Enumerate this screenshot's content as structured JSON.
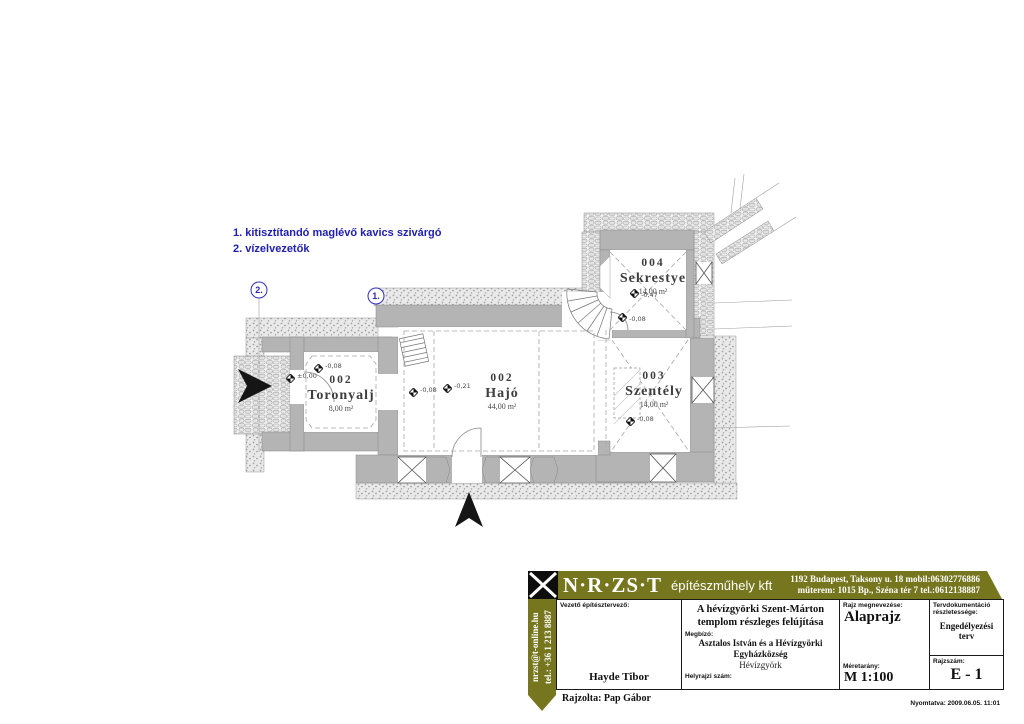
{
  "notes": {
    "line1": "1. kitisztítandó maglévő kavics szivárgó",
    "line2": "2. vízelvezetők",
    "color": "#2020b2"
  },
  "plan": {
    "rooms": [
      {
        "number": "002",
        "name": "Toronyalj",
        "area": "8,00 m²"
      },
      {
        "number": "002",
        "name": "Hajó",
        "area": "44,00 m²"
      },
      {
        "number": "003",
        "name": "Szentély",
        "area": "14,00 m²"
      },
      {
        "number": "004",
        "name": "Sekrestye",
        "area": "14,00 m²"
      }
    ],
    "levels": {
      "entry": "±0,00",
      "tower_ne": "-0,08",
      "hajo_w": "-0,08",
      "hajo": "-0,21",
      "szentely": "-0,08",
      "sekrestye_upper": "-0,47",
      "sekrestye_lower": "-0,08"
    },
    "callout_1": "1.",
    "callout_2": "2."
  },
  "titleblock": {
    "brand": "N·R·ZS·T",
    "brand_sub": "építészműhely kft",
    "brand_color": "#76761f",
    "address_line1": "1192 Budapest, Taksony u. 18  mobil:06302776886",
    "address_line2": "műterem: 1015 Bp., Széna tér 7 tel.:0612138887",
    "email_vertical": "nrzst@t-online.hu",
    "phone_vertical": "tel.: +36 1 213 8887",
    "lead_label": "Vezető építésztervező:",
    "lead_name": "Hayde Tibor",
    "drawn_by": "Rajzolta: Pap Gábor",
    "project_title_line1": "A hévízgyörki Szent-Márton",
    "project_title_line2": "templom részleges felújítása",
    "client_label": "Megbízó:",
    "client_line1": "Asztalos István és a Hévízgyörki",
    "client_line2": "Egyházközség",
    "client_city": "Hévízgyörk",
    "parcel_label": "Helyrajzi szám:",
    "drawing_label": "Rajz megnevezése:",
    "drawing_name": "Alaprajz",
    "scale_label": "Méretarány:",
    "scale_value": "M 1:100",
    "detail_label": "Tervdokumentáció részletessége:",
    "detail_value": "Engedélyezési terv",
    "number_label": "Rajzszám:",
    "number_value": "E - 1",
    "printed": "Nyomtatva: 2009.06.05. 11:01"
  }
}
